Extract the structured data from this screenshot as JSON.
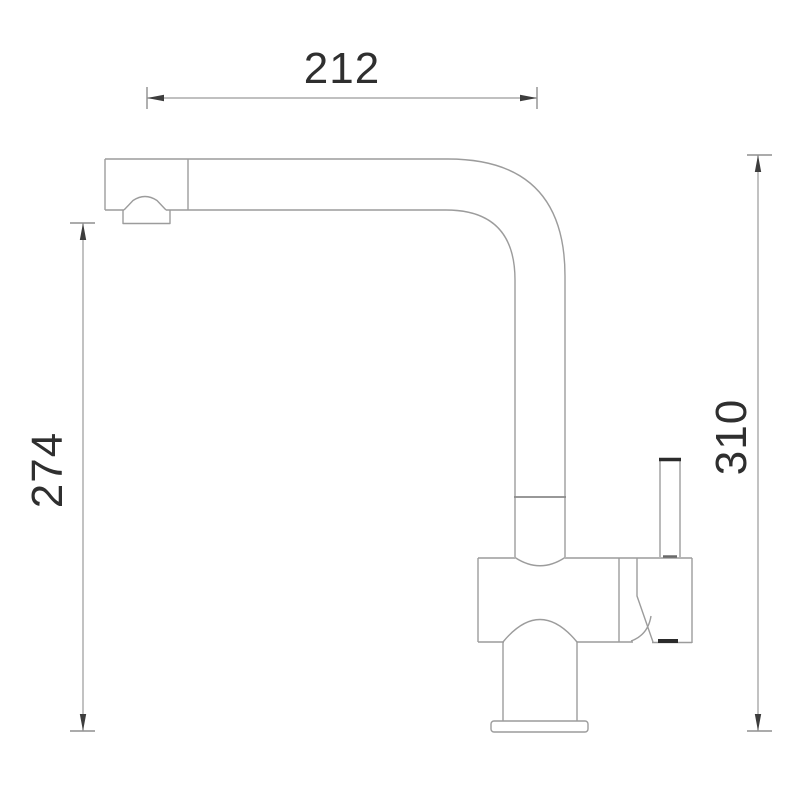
{
  "page": {
    "background_color": "#ffffff"
  },
  "drawing": {
    "subject": "single-lever-kitchen-mixer-tap-side-view",
    "dimensions": {
      "spout_reach": {
        "label": "212"
      },
      "spout_height": {
        "label": "274"
      },
      "total_height": {
        "label": "310"
      }
    },
    "colors": {
      "outline": "#9c9c9c",
      "dimension_line": "#9a9a9a",
      "arrow": "#3d3d3d",
      "label_text": "#2f2f2f"
    }
  }
}
